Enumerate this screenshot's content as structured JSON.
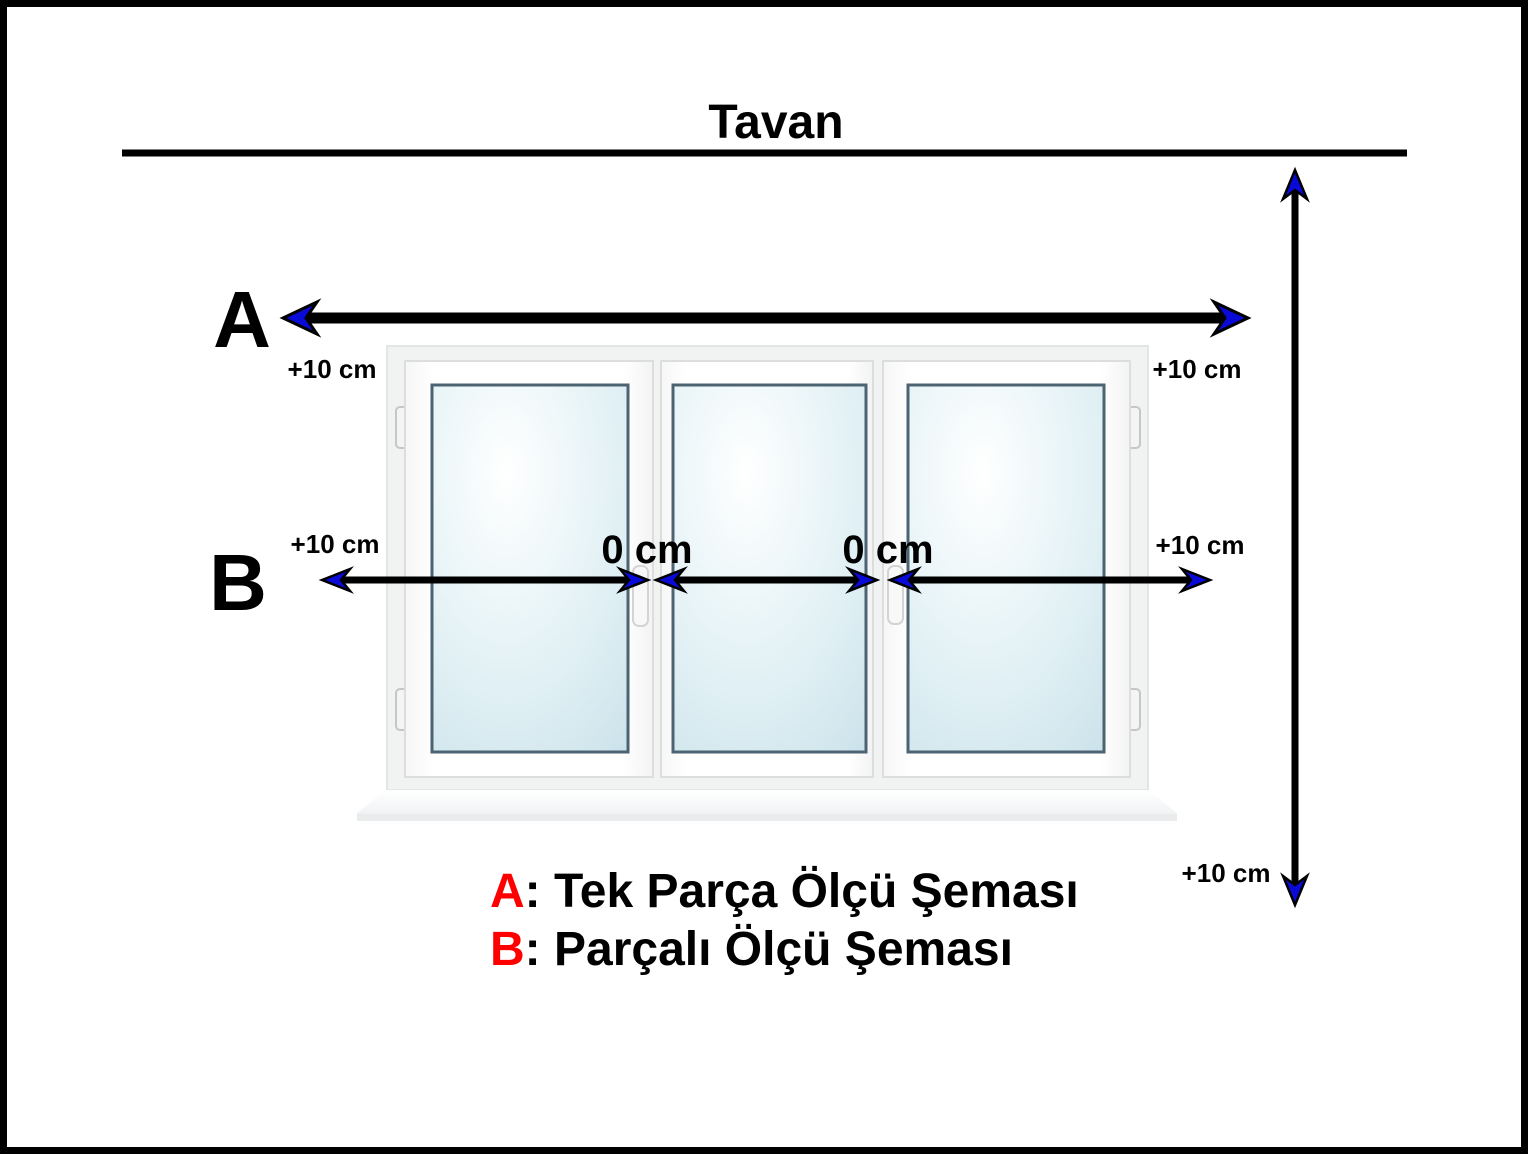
{
  "title": "Tavan",
  "arrow_a": {
    "letter": "A",
    "left_offset": "+10 cm",
    "right_offset": "+10 cm"
  },
  "arrow_b": {
    "letter": "B",
    "left_offset": "+10 cm",
    "right_offset": "+10 cm",
    "gap_1": "0 cm",
    "gap_2": "0 cm"
  },
  "vertical_arrow": {
    "bottom_offset": "+10 cm"
  },
  "legend": {
    "items": [
      {
        "key": "A",
        "text": ": Tek Parça Ölçü Şeması"
      },
      {
        "key": "B",
        "text": ": Parçalı Ölçü Şeması"
      }
    ]
  },
  "colors": {
    "accent_red": "#ff0000",
    "line_black": "#000000",
    "arrowhead_blue": "#0a0ad8",
    "glass_border": "#4c6372"
  }
}
